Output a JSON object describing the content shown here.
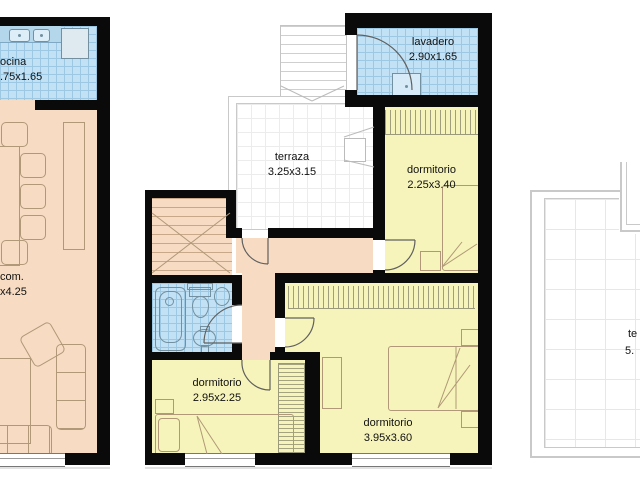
{
  "document_type": "architectural floor plans",
  "colors": {
    "wall": "#0a0a0a",
    "living_floor": "#f7dcc3",
    "bedroom_floor": "#f6f4ba",
    "wet_floor": "#c2e1f4",
    "wet_grid": "#9cc8e4",
    "terrace_line": "#c9c9c9",
    "furniture_line": "#b09878",
    "label_text": "#111111"
  },
  "plans": {
    "left": {
      "name": "living-kitchen-partial",
      "rooms": {
        "kitchen": {
          "label": "ocina",
          "dims": ".75x1.65"
        },
        "living": {
          "label": "com.",
          "dims": "x4.25"
        }
      }
    },
    "middle": {
      "name": "bedrooms-level",
      "rooms": {
        "laundry": {
          "label": "lavadero",
          "dims": "2.90x1.65"
        },
        "terrace": {
          "label": "terraza",
          "dims": "3.25x3.15"
        },
        "bedroom1": {
          "label": "dormitorio",
          "dims": "2.25x3.40"
        },
        "bedroom2": {
          "label": "dormitorio",
          "dims": "2.95x2.25"
        },
        "bedroom3": {
          "label": "dormitorio",
          "dims": "3.95x3.60"
        }
      }
    },
    "right": {
      "name": "terrace-partial",
      "rooms": {
        "terrace": {
          "label": "te",
          "dims": "5."
        }
      }
    }
  }
}
